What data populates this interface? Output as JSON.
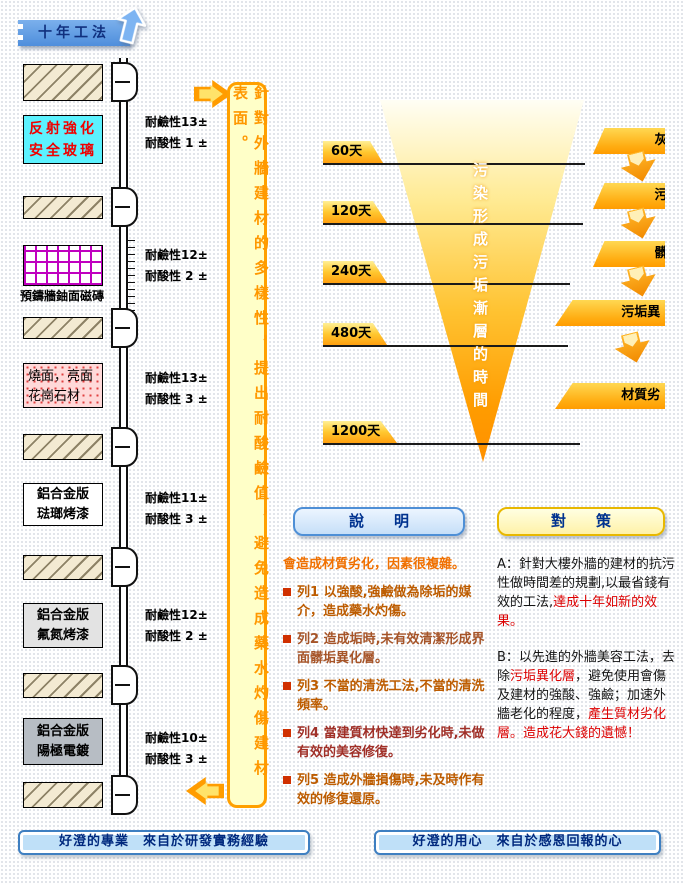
{
  "header": {
    "tab_label": "十年工法"
  },
  "wall": {
    "glass_label": "反射強化\n安全玻璃",
    "tile_caption": "預鑄牆鈾面磁磚",
    "granite_label": "燒面，亮面花崗石材",
    "panel_enamel_label": "鋁合金版\n琺瑯烤漆",
    "panel_fluorine_label": "鋁合金版\n氟氮烤漆",
    "panel_anodized_label": "鋁合金版\n陽極電鍍",
    "ratings": [
      {
        "alkali": "耐鹼性13±",
        "acid": "耐酸性 1 ±"
      },
      {
        "alkali": "耐鹼性12±",
        "acid": "耐酸性 2 ±"
      },
      {
        "alkali": "耐鹼性13±",
        "acid": "耐酸性 3 ±"
      },
      {
        "alkali": "耐鹼性11±",
        "acid": "耐酸性 3 ±"
      },
      {
        "alkali": "耐鹼性12±",
        "acid": "耐酸性 2 ±"
      },
      {
        "alkali": "耐鹼性10±",
        "acid": "耐酸性 3 ±"
      }
    ]
  },
  "message_box": {
    "text": "針對外牆建材的多樣性，提出耐酸鹼值，避免造成藥水灼傷建材表面。"
  },
  "funnel": {
    "title": "污染形成污垢漸層的時間",
    "times": [
      "60天",
      "120天",
      "240天",
      "480天",
      "1200天"
    ],
    "layers": [
      "灰塵層",
      "污染層",
      "髒垢層",
      "污垢異化層",
      "材質劣化層"
    ]
  },
  "explanation": {
    "button": "說　　明",
    "heading": "會造成材質劣化，因素很複雜。",
    "items": [
      "列1 以強酸,強鹼做為除垢的媒介，造成藥水灼傷。",
      "列2 造成垢時,未有效清潔形成界面髒垢異化層。",
      "列3 不當的清洗工法,不當的清洗頻率。",
      "列4 當建質材快達到劣化時,未做有效的美容修復。",
      "列5 造成外牆損傷時,未及時作有效的修復還原。"
    ]
  },
  "countermeasures": {
    "button": "對　　策",
    "a_prefix": "A：針對大樓外牆的建材的抗污性做時間差的規劃,以最省錢有效的工法,",
    "a_highlight": "達成十年如新的效果。",
    "b_prefix": "B：以先進的外牆美容工法，去除",
    "b_highlight1": "污垢異化層",
    "b_middle": "，避免使用會傷及建材的強酸、強鹼；加速外牆老化的程度，",
    "b_highlight2": "產生質材劣化層。造成花大錢的遺憾！"
  },
  "footer": {
    "left": "好澄的專業　來自於研發實務經驗",
    "right": "好澄的用心　來自於感恩回報的心"
  },
  "colors": {
    "tab_blue": "#5B9BE0",
    "accent_orange": "#FF9C00",
    "message_yellow": "#FFFFC8",
    "highlight_red": "#DD0000",
    "banner_light_blue": "#BFE0F8"
  }
}
